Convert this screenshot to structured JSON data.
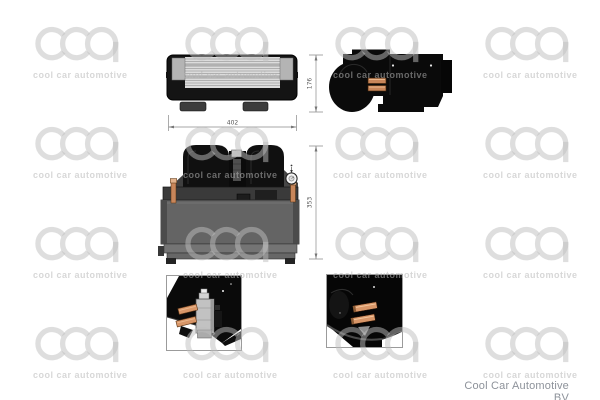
{
  "watermark": {
    "logo": "cca",
    "caption": "cool car automotive"
  },
  "dimensions": {
    "width": "402",
    "side_height": "176",
    "front_height": "353"
  },
  "footer": {
    "brand": "Cool Car Automotive BV"
  },
  "colors": {
    "copper": "#c8865a",
    "copper_light": "#d89668",
    "body_gray": "#646464",
    "drawing_black": "#0a0a0a",
    "watermark_gray": "#bebebe",
    "footer_text": "#8d929a"
  }
}
